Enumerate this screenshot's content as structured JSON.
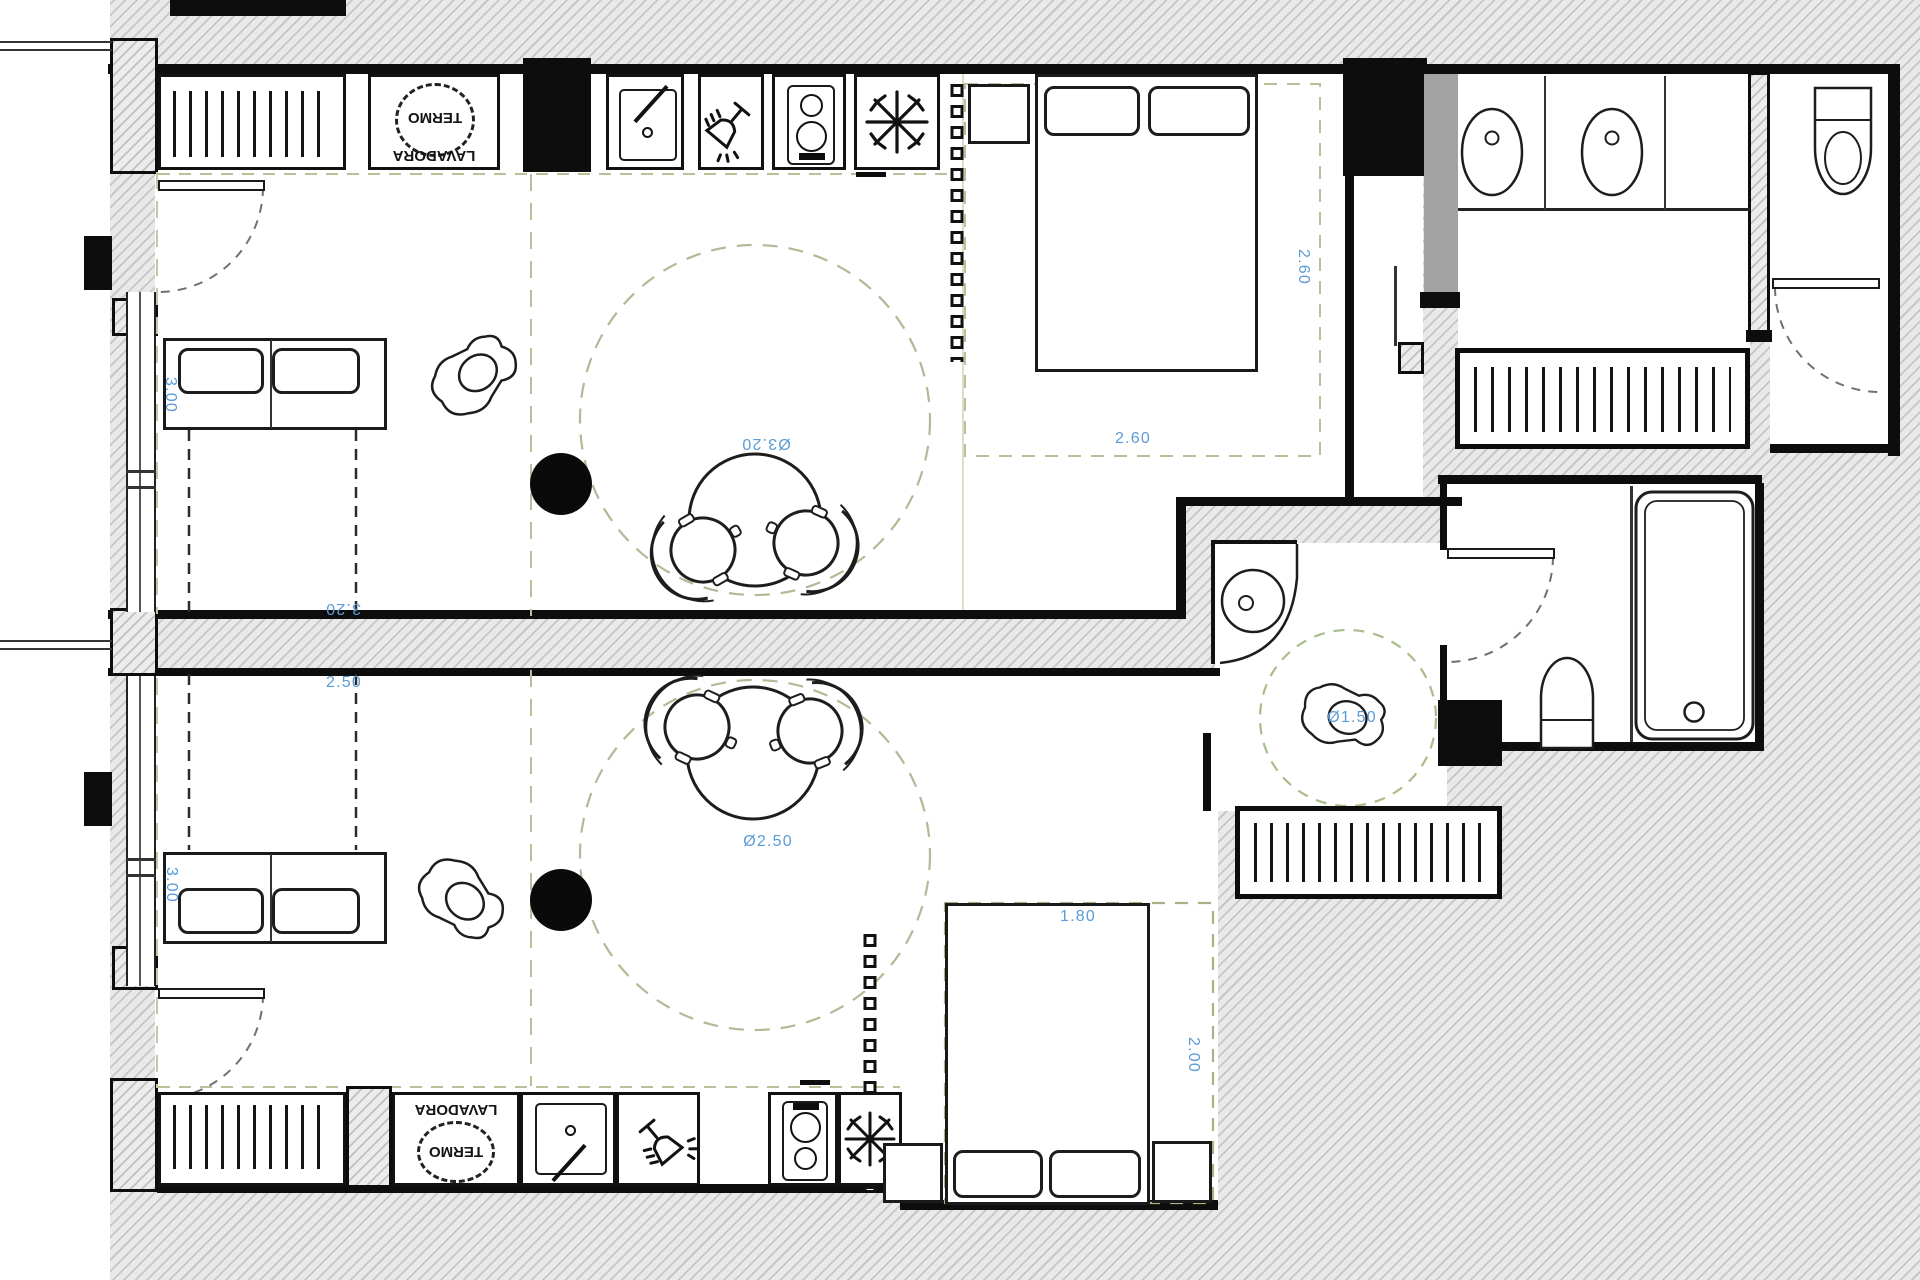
{
  "plan": {
    "type": "architectural-floor-plan",
    "units": {
      "upper": {
        "appliances": {
          "termo": "TERMO",
          "lavadora": "LAVADORA"
        },
        "dimensions": {
          "sofa_bed_length": "3.00",
          "dining_clearance": "Ø3.20",
          "living_width": "3.20",
          "bedroom_width": "2.60",
          "bedroom_depth": "2.60"
        }
      },
      "lower": {
        "appliances": {
          "termo": "TERMO",
          "lavadora": "LAVADORA"
        },
        "dimensions": {
          "living_width": "2.50",
          "sofa_bed_length": "3.00",
          "dining_clearance": "Ø2.50",
          "bed_width": "1.80",
          "bed_depth": "2.00",
          "turning_circle": "Ø1.50"
        }
      }
    },
    "colors": {
      "dimension_text": "#5b9bd5",
      "clearance_dash": "#b4b897",
      "wall": "#0d0d0d",
      "door_panel_gray": "#a3a3a3",
      "hatch_line": "#c6c6c6",
      "hatch_bg": "#e9e9e9"
    },
    "icons": [
      "radiator-icon",
      "water-heater-icon",
      "sink-icon",
      "dishwasher-glass-icon",
      "hob-icon",
      "freezer-snowflake-icon",
      "bed",
      "pillow",
      "nightstand",
      "sofa-bed",
      "round-dining-table",
      "dining-chair",
      "armchair",
      "double-sink-vanity",
      "toilet",
      "bathtub",
      "corner-washbasin",
      "door-swing-icon",
      "curtain-track-icon",
      "structural-column"
    ]
  }
}
